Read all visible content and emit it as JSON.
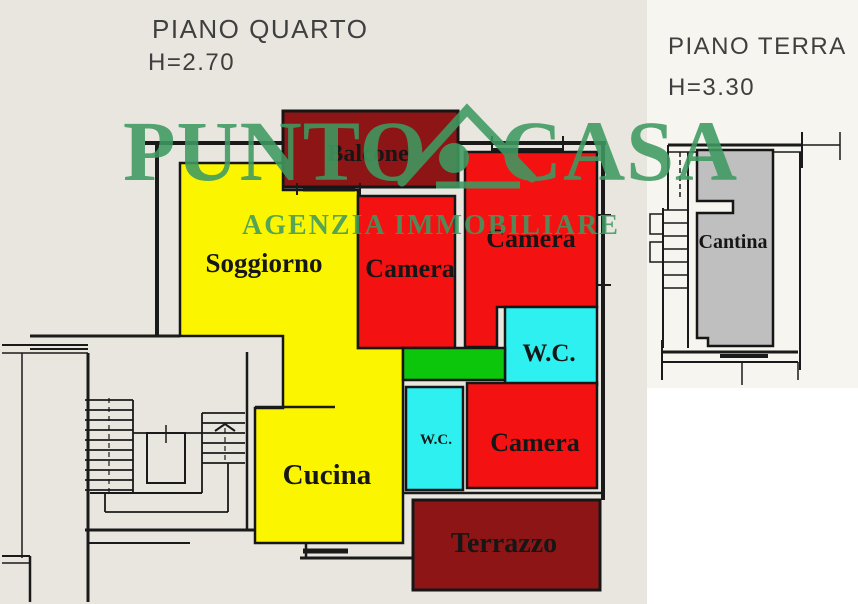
{
  "plans": {
    "piano_quarto": {
      "title": "PIANO QUARTO",
      "ceiling_height": "H=2.70"
    },
    "piano_terra": {
      "title": "PIANO TERRA",
      "ceiling_height": "H=3.30"
    }
  },
  "watermark": {
    "brand_first": "PUNTO",
    "brand_second": "CASA",
    "tagline": "AGENZIA IMMOBILIARE",
    "color": "#3E9A61"
  },
  "rooms": {
    "balcone": {
      "label": "Balcone",
      "color": "#8E1515"
    },
    "soggiorno": {
      "label": "Soggiorno",
      "color": "#FBF600"
    },
    "camera_center": {
      "label": "Camera",
      "color": "#F31111"
    },
    "camera_top": {
      "label": "Camera",
      "color": "#F31111"
    },
    "camera_bottom": {
      "label": "Camera",
      "color": "#F31111"
    },
    "wc_main": {
      "label": "W.C.",
      "color": "#2FF0F0"
    },
    "wc_small": {
      "label": "W.C.",
      "color": "#2FF0F0"
    },
    "cucina": {
      "label": "Cucina",
      "color": "#FBF600"
    },
    "terrazzo": {
      "label": "Terrazzo",
      "color": "#8E1515"
    },
    "disimpegno": {
      "color": "#0BC60B"
    },
    "cantina": {
      "label": "Cantina",
      "color": "#BFBFBF"
    }
  },
  "colors": {
    "paper_main": "#E9E6E0",
    "paper_right": "#F7F5EF",
    "wall_ink": "#1A1A1A"
  }
}
